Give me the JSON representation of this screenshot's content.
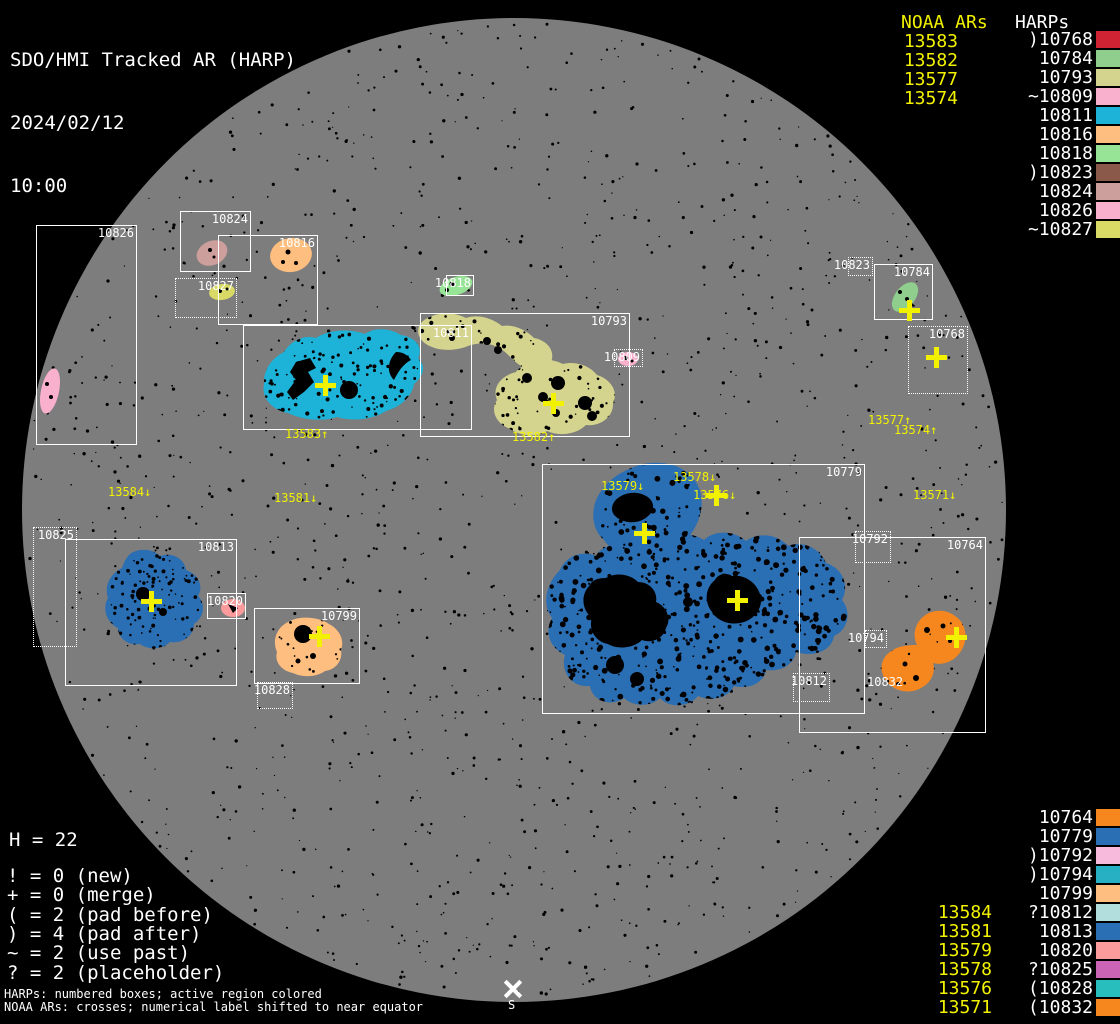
{
  "header": {
    "title": "SDO/HMI Tracked AR (HARP)",
    "date": "2024/02/12",
    "time": "10:00"
  },
  "columns": {
    "noaa_header": "NOAA ARs",
    "harps_header": "HARPs",
    "top_noaa": [
      "13583",
      "13582",
      "13577",
      "13574"
    ],
    "top_harps": [
      {
        "prefix": ")",
        "id": "10768",
        "color": "#cf2233"
      },
      {
        "prefix": "",
        "id": "10784",
        "color": "#8fce8c"
      },
      {
        "prefix": "",
        "id": "10793",
        "color": "#d4d48e"
      },
      {
        "prefix": "~",
        "id": "10809",
        "color": "#f8b0cc"
      },
      {
        "prefix": "",
        "id": "10811",
        "color": "#1db2d8"
      },
      {
        "prefix": "",
        "id": "10816",
        "color": "#fdbe7f"
      },
      {
        "prefix": "",
        "id": "10818",
        "color": "#97e497"
      },
      {
        "prefix": ")",
        "id": "10823",
        "color": "#8b5949"
      },
      {
        "prefix": "",
        "id": "10824",
        "color": "#cc9e9c"
      },
      {
        "prefix": "",
        "id": "10826",
        "color": "#f8b0cc"
      },
      {
        "prefix": "~",
        "id": "10827",
        "color": "#d9d966"
      }
    ],
    "bottom_noaa": [
      "13584",
      "13581",
      "13579",
      "13578",
      "13576",
      "13571"
    ],
    "bottom_harps": [
      {
        "prefix": "",
        "id": "10764",
        "color": "#f6871f"
      },
      {
        "prefix": "",
        "id": "10779",
        "color": "#2a6eb4"
      },
      {
        "prefix": ")",
        "id": "10792",
        "color": "#f7badd"
      },
      {
        "prefix": ")",
        "id": "10794",
        "color": "#27afc4"
      },
      {
        "prefix": "",
        "id": "10799",
        "color": "#fdbe7f"
      },
      {
        "prefix": "?",
        "id": "10812",
        "color": "#b2dede"
      },
      {
        "prefix": "",
        "id": "10813",
        "color": "#2a6eb4"
      },
      {
        "prefix": "",
        "id": "10820",
        "color": "#fb9b9b"
      },
      {
        "prefix": "?",
        "id": "10825",
        "color": "#cb64b4"
      },
      {
        "prefix": "(",
        "id": "10828",
        "color": "#28bebe"
      },
      {
        "prefix": "(",
        "id": "10832",
        "color": "#f6871f"
      }
    ]
  },
  "stats": {
    "h_line": "H = 22",
    "flags": [
      "! = 0 (new)",
      "+ = 0 (merge)",
      "( = 2 (pad before)",
      ") = 4 (pad after)",
      "~ = 2 (use past)",
      "? = 2 (placeholder)"
    ]
  },
  "footnotes": [
    "HARPs: numbered boxes; active region colored",
    "NOAA ARs: crosses; numerical label shifted to near equator"
  ],
  "disk": {
    "regions": [
      {
        "id": "10826",
        "box": "solid"
      },
      {
        "id": "10824",
        "box": "solid"
      },
      {
        "id": "10816",
        "box": "solid"
      },
      {
        "id": "10827",
        "box": "dotted"
      },
      {
        "id": "10818",
        "box": "solid"
      },
      {
        "id": "10811",
        "box": "solid"
      },
      {
        "id": "10793",
        "box": "solid"
      },
      {
        "id": "10809",
        "box": "dotted"
      },
      {
        "id": "10823",
        "box": "dotted"
      },
      {
        "id": "10784",
        "box": "solid"
      },
      {
        "id": "10768",
        "box": "dotted"
      },
      {
        "id": "10779",
        "box": "solid"
      },
      {
        "id": "10792",
        "box": "dotted"
      },
      {
        "id": "10764",
        "box": "solid"
      },
      {
        "id": "10794",
        "box": "dotted"
      },
      {
        "id": "10812",
        "box": "dotted"
      },
      {
        "id": "10825",
        "box": "dotted"
      },
      {
        "id": "10813",
        "box": "solid"
      },
      {
        "id": "10820",
        "box": "solid"
      },
      {
        "id": "10799",
        "box": "solid"
      },
      {
        "id": "10828",
        "box": "dotted"
      },
      {
        "id": "10832",
        "box": "none"
      }
    ],
    "noaa_shifted_labels": [
      "13583↑",
      "13582↑",
      "13584↓",
      "13581↓",
      "13579↓",
      "13578↓",
      "13576↓",
      "13577↑",
      "13574↑",
      "13571↓"
    ],
    "south_label": "S"
  },
  "palette": {
    "disk_gray": "#7d7d7d",
    "background": "#000000",
    "box_line": "#ffffff",
    "noaa_yellow": "#f2f200",
    "10768": "#cf2233",
    "10784": "#8fce8c",
    "10793": "#d4d48e",
    "10809": "#f8b0cc",
    "10811": "#1db2d8",
    "10816": "#fdbe7f",
    "10818": "#97e497",
    "10823": "#8b5949",
    "10824": "#cc9e9c",
    "10826": "#f8b0cc",
    "10827": "#d9d966",
    "10764": "#f6871f",
    "10779": "#2a6eb4",
    "10792": "#f7badd",
    "10794": "#27afc4",
    "10799": "#fdbe7f",
    "10812": "#b2dede",
    "10813": "#2a6eb4",
    "10820": "#fb9b9b",
    "10825": "#cb64b4",
    "10828": "#28bebe",
    "10832": "#f6871f"
  }
}
